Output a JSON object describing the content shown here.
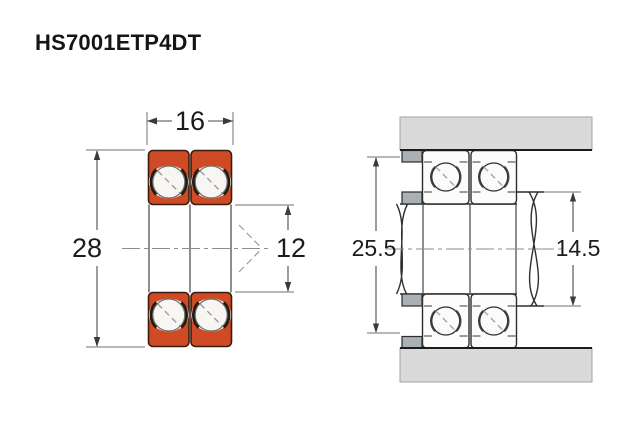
{
  "title": "HS7001ETP4DT",
  "colors": {
    "bearing_orange": "#ce4b26",
    "bearing_outline": "#3a1d0e",
    "housing_gray": "#dadada",
    "spacer_gray": "#a9b1b5",
    "ball_white": "#f7f6f3"
  },
  "left_view": {
    "dimensions": {
      "width": "16",
      "outer_diameter": "28",
      "bore": "12"
    }
  },
  "right_view": {
    "dimensions": {
      "housing_abutment": "25.5",
      "shaft_abutment": "14.5"
    }
  }
}
